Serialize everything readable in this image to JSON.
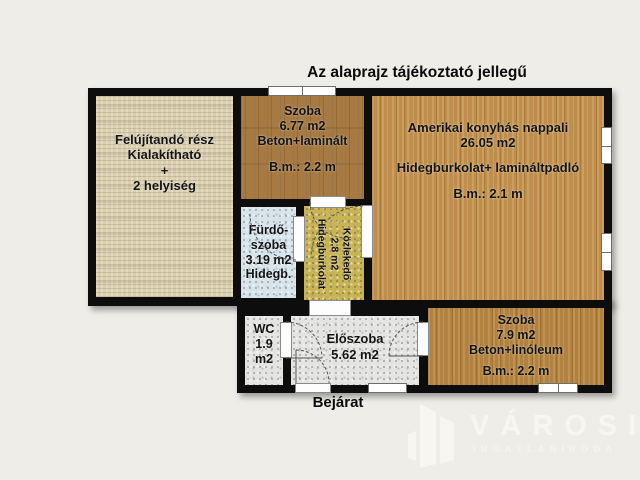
{
  "title": "Az alaprajz tájékoztató jellegű",
  "entrance_label": "Bejárat",
  "rooms": {
    "renovation": {
      "lines": [
        "Felújítandó rész",
        "Kialakítható",
        "+",
        "2 helyiség"
      ]
    },
    "bedroom_top": {
      "name": "Szoba",
      "area": "6.77 m2",
      "floor": "Beton+laminált",
      "ceiling": "B.m.: 2.2 m"
    },
    "living_room": {
      "name": "Amerikai konyhás nappali",
      "area": "26.05 m2",
      "floor": "Hidegburkolat+ lamináltpadló",
      "ceiling": "B.m.: 2.1 m"
    },
    "bathroom": {
      "lines": [
        "Fürdő-",
        "szoba",
        "3.19 m2",
        "Hidegb."
      ]
    },
    "corridor": {
      "name": "Közlekedő",
      "area": "2.8 m2",
      "floor": "Hidegburkolat"
    },
    "wc": {
      "name": "WC",
      "area": "1.9 m2"
    },
    "entry_hall": {
      "name": "Előszoba",
      "area": "5.62 m2"
    },
    "bedroom_bottom": {
      "name": "Szoba",
      "area": "7.9 m2",
      "floor": "Beton+linóleum",
      "ceiling": "B.m.: 2.2 m"
    }
  },
  "logo": {
    "brand": "VÁROSI",
    "subtitle": "INGATLANIRODA"
  },
  "colors": {
    "background": "#efede8",
    "wall": "#0d0d0d",
    "wood_dark": "#a77a43",
    "wood_light": "#c08e4a",
    "wood_medium": "#b3813e",
    "renovation_floor": "#d9cfb0",
    "bathroom_floor": "#d7e4ec",
    "corridor_floor": "#c9b455",
    "tile_gray": "#e4e4e2",
    "logo_text": "#f8f6f1"
  }
}
